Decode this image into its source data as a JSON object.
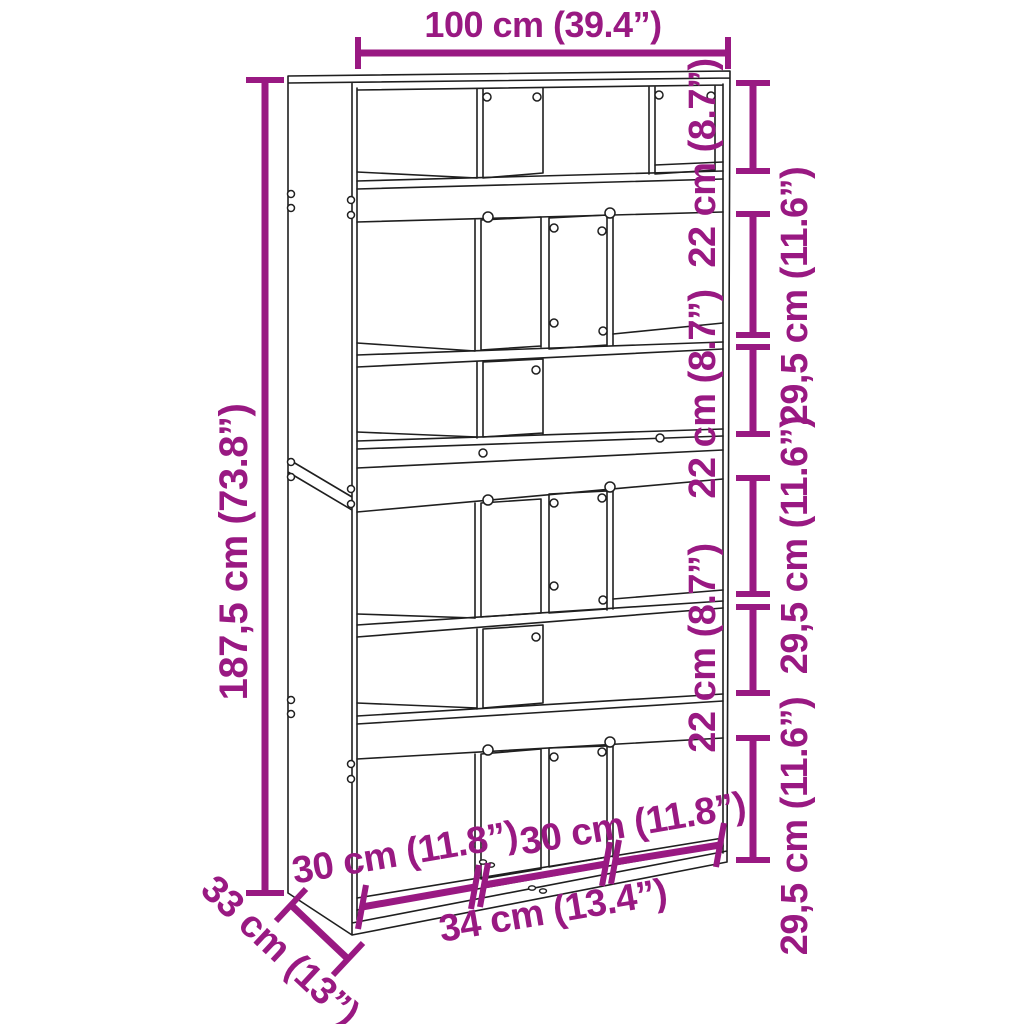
{
  "colors": {
    "dimension": "#991982",
    "line": "#1f1f1f",
    "background": "#ffffff"
  },
  "diagram": {
    "subject": "room-divider bookcase line drawing with dimension annotations",
    "dimensions": {
      "width": {
        "label": "100 cm (39.4”)"
      },
      "height": {
        "label": "187,5 cm (73.8”)"
      },
      "depth": {
        "label": "33 cm (13”)"
      },
      "right_segments": [
        {
          "label": "22 cm (8.7”)"
        },
        {
          "label": "29,5 cm (11.6”)"
        },
        {
          "label": "22 cm (8.7”)"
        },
        {
          "label": "29,5 cm (11.6”)"
        },
        {
          "label": "22 cm (8.7”)"
        },
        {
          "label": "29,5 cm (11.6”)"
        }
      ],
      "bottom_segments": [
        {
          "label": "30 cm (11.8”)"
        },
        {
          "label": "34 cm (13.4”)"
        },
        {
          "label": "30 cm (11.8”)"
        }
      ]
    }
  }
}
